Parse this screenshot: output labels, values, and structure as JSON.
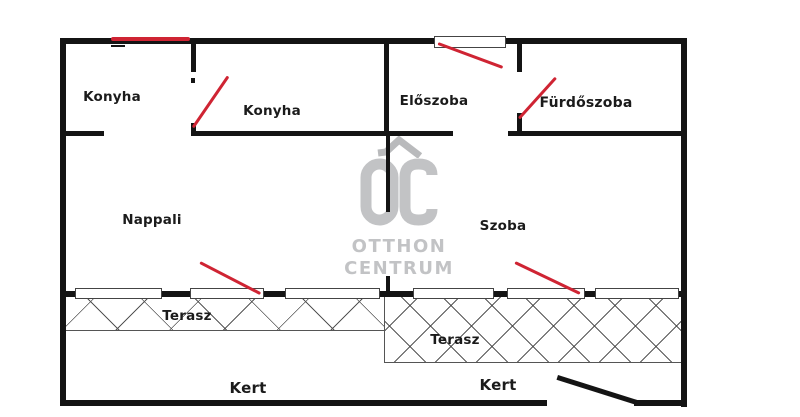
{
  "plan_title": "Apartment floor plan",
  "watermark": {
    "monogram": "OC",
    "line1": "OTTHON",
    "line2": "CENTRUM"
  },
  "rooms": {
    "konyha_left": {
      "label": "Konyha"
    },
    "konyha_right": {
      "label": "Konyha"
    },
    "eloszoba": {
      "label": "Előszoba"
    },
    "furdoszoba": {
      "label": "Fürdőszoba"
    },
    "nappali": {
      "label": "Nappali"
    },
    "szoba": {
      "label": "Szoba"
    },
    "terasz_left": {
      "label": "Terasz"
    },
    "terasz_right": {
      "label": "Terasz"
    },
    "kert_left": {
      "label": "Kert"
    },
    "kert_right": {
      "label": "Kert"
    }
  },
  "colors": {
    "wall": "#141414",
    "door_marker": "#cf2433",
    "watermark": "#c2c3c5",
    "hatch_line": "#555555",
    "background": "#ffffff"
  }
}
